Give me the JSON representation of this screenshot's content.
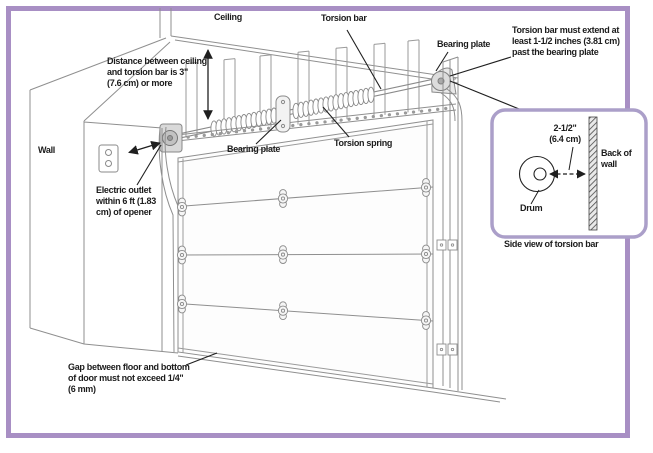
{
  "diagram": {
    "type": "garage-door-torsion-bar-installation",
    "colors": {
      "page_border": "#a88fc4",
      "inset_border": "#ab9fc9",
      "line_gray": "#8f8f8f",
      "annotation_black": "#1f1f1f"
    },
    "labels": {
      "ceiling": "Ceiling",
      "torsion_bar": "Torsion bar",
      "bearing_plate_top": "Bearing plate",
      "extend_note": "Torsion bar must extend at\nleast 1-1/2 inches (3.81 cm)\npast the bearing plate",
      "distance_note": "Distance between ceiling\nand torsion bar is 3\"\n(7.6 cm) or more",
      "wall": "Wall",
      "bearing_plate_center": "Bearing plate",
      "torsion_spring": "Torsion spring",
      "outlet_note": "Electric outlet\nwithin 6 ft (1.83\ncm) of opener",
      "gap_note": "Gap between floor and bottom\nof door must not exceed 1/4\"\n(6 mm)"
    },
    "inset": {
      "dimension": "2-1/2\"\n(6.4 cm)",
      "back_of_wall": "Back of\nwall",
      "drum": "Drum",
      "caption": "Side view of torsion bar"
    }
  }
}
